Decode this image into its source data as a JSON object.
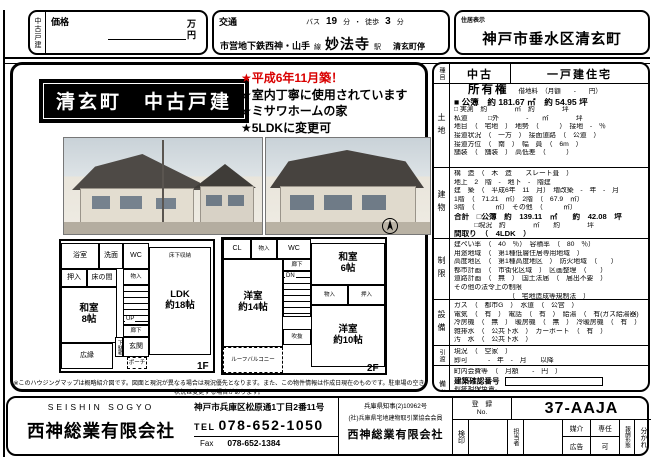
{
  "colors": {
    "accent_red": "#d90000",
    "ink": "#000000"
  },
  "top": {
    "side_label": "中古戸建",
    "price": {
      "label": "価格",
      "unit": "万\n円"
    },
    "transport": {
      "label": "交通",
      "bus": "バス",
      "bus_min": "19",
      "min_a": "分",
      "sep": "・",
      "walk": "徒歩",
      "walk_min": "3",
      "min_b": "分",
      "line": "市営地下鉄西神・山手",
      "line_sfx": "線",
      "station": "妙法寺",
      "station_sfx": "駅",
      "stop": "清玄町停"
    },
    "address": {
      "label": "住居表示",
      "value": "神戸市垂水区清玄町"
    }
  },
  "main": {
    "title": "清玄町　中古戸建",
    "bullets": {
      "b0": "★平成6年11月築！",
      "b1": "★室内丁寧に使用されています",
      "b2": "★ミサワホームの家",
      "b3": "★5LDKに変更可"
    },
    "floor1": {
      "label": "1F",
      "bath": "浴室",
      "wash": "洗面",
      "wc": "WC",
      "yukashita": "床下収納",
      "ldk": "LDK\n約18帖",
      "oshiire": "押入",
      "tokonoma": "床の間",
      "monoire": "物入",
      "washitsu": "和室\n8帖",
      "up": "UP",
      "rouka": "廊下",
      "getabako": "下駄箱",
      "genkan": "玄関",
      "porch": "ポーチ",
      "hiroen": "広縁"
    },
    "floor2": {
      "label": "2F",
      "cl": "CL",
      "monoire": "物入",
      "wc": "WC",
      "rouka": "廊下",
      "dn": "DN",
      "washitsu": "和室\n6帖",
      "monoire2": "物入",
      "oshiire": "押入",
      "y14": "洋室\n約14帖",
      "y10": "洋室\n約10帖",
      "fukinuke": "吹抜",
      "balcony": "ルーフバルコニー"
    },
    "disclaimer": "※このハウジングマップは概略紹介図です。図面と現況が異なる場合は現況優先となります。また、この物件情報は作成日現在のものです。駐車場の空き状況は変更する場合があります。"
  },
  "details": {
    "sec1": {
      "header": "種目",
      "category": "中古",
      "type": "一戸建住宅"
    },
    "land": {
      "header": "土地",
      "ownership": "所有権",
      "rent": "借地料　（月額　　-　　円）",
      "kouho": "■ 公簿　約 181.67 ㎡　約 54.95 坪",
      "jissoku": "□ 実測　約　　　　㎡　約　　　　坪",
      "shidou": "私道　　　□外　　　　-　　㎡　　　　坪",
      "chimoku": "地目　（　宅地　）　地勢　（　　　）　接地　-　％",
      "setsudo": "接道状況　（　一方　）　接面道路　（　公道　）",
      "houi": "接道方位　（　南　）　幅　員　（　6m　）",
      "hosou": "舗装　（　舗装　）　高低差　（　　　）"
    },
    "building": {
      "header": "建物",
      "structure": "構　造　（　木　造　　スレート葺　）",
      "floors": "地上　2　階　-　地下　-　階建",
      "built": "建　築　（　平成6年　11　月）　増改築　-　年　-　月",
      "f12": "1階　（　71.21　㎡）　2階　（　67.9　㎡）",
      "f3o": "3階　（　　　㎡）　その他　（　　　㎡）",
      "total1": "合計　□公簿　約　139.11　㎡　　約　42.08　坪",
      "total2": "　　　□現況　約　　　　㎡　　約　　　　坪",
      "madori": "間取り　（　4LDK　）"
    },
    "restrictions": {
      "header": "制限",
      "kenpei": "建ぺい率　（　40　％）　容積率　（　80　％）",
      "youto": "用途地域　（　第1種低層住居専用地域　）",
      "koudo": "高度地区　（　第1種高度地区　）　防火地域　（　　）",
      "toshi": "都市計画　（　市街化区域　）　区画整理　（　　）",
      "douro": "道路計画　（　無　）　国土法届　（　届出不要　）",
      "other_label": "その他の法令上の制限",
      "other": "（　宅地造成等規制法　）"
    },
    "facilities": {
      "header": "設備",
      "gas": "ガス　（　都市G　）　水道　（　公営　）",
      "denki": "電気　（　有　）　電話　（　有　）　給湯　（　有(ガス給湯器)　）",
      "reibou": "冷房機　（　無　）　暖房機　（　無　）　冷暖房機　（　有　）",
      "haisui": "雑排水　（　公共下水　）　カーポート　（　有　）",
      "osui": "汚　水　（　公共下水　）"
    },
    "handover": {
      "header": "引渡",
      "genkyou": "現況　（　空家　）",
      "timing": "即可　　　-　年　-　月　　以降"
    },
    "notes": {
      "header": "備考",
      "fees": "町内会費等　（　月額　　-　円　）",
      "kakunin": "建築確認番号",
      "r1": "瑕疵担保免責。",
      "r2": "債権者の抹消同意要。",
      "r3": "ご案内の際は、080-8794-1410迄"
    }
  },
  "footer": {
    "company_en": "SEISHIN  SOGYO",
    "company": "西神総業有限会社",
    "address": "神戸市兵庫区松原通1丁目2番11号",
    "tel_label": "TEL",
    "tel": "078-652-1050",
    "fax_label": "Fax",
    "fax": "078-652-1384",
    "license": "兵庫県知事(2)10962号",
    "member": "(社)兵庫県宅地建物取引業協会会員",
    "company2": "西神総業有限会社",
    "reg_label": "登　録\nNo.",
    "reg_no": "37-AAJA",
    "kenin": "検印",
    "tantou": "担当者",
    "baikai": "媒介",
    "senin": "専任",
    "koukoku": "広告",
    "ka": "可",
    "houshuu": "報酬形態",
    "wakare": "分かれ"
  }
}
